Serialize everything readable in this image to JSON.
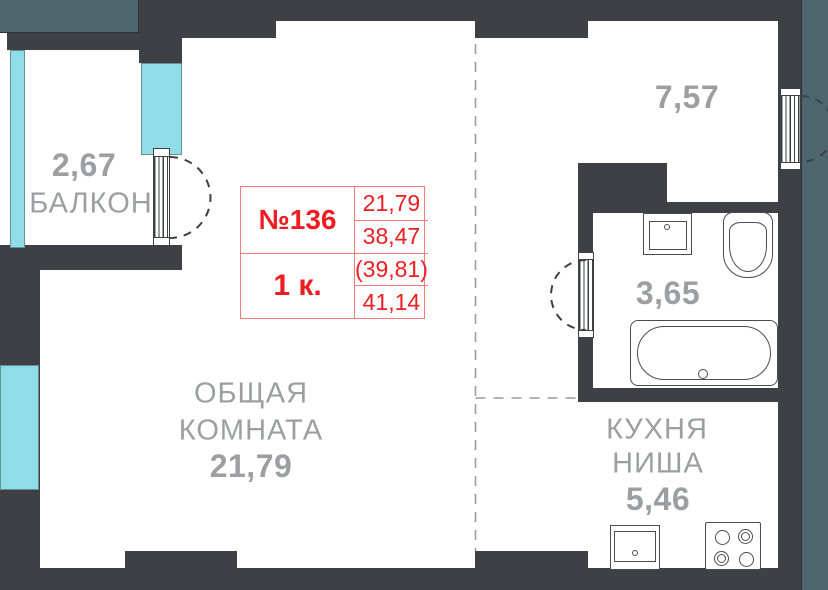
{
  "palette": {
    "wall": "#3f4046",
    "outside": "#4d666e",
    "glass": "#90dde8",
    "label": "#9c9ea1",
    "red_text": "#ee1d23",
    "red_border": "#f57c7c",
    "fixture": "#4b4c52",
    "zone": "#9a9a9a"
  },
  "info_card": {
    "number": "№136",
    "type": "1 к.",
    "areas": [
      "21,79",
      "38,47",
      "(39,81)",
      "41,14"
    ]
  },
  "rooms": {
    "balcony": {
      "area": "2,67",
      "name": "БАЛКОН"
    },
    "living": {
      "name_line1": "ОБЩАЯ",
      "name_line2": "КОМНАТА",
      "area": "21,79"
    },
    "hall": {
      "area": "7,57"
    },
    "bathroom": {
      "area": "3,65"
    },
    "kitchen": {
      "name_line1": "КУХНЯ",
      "name_line2": "НИША",
      "area": "5,46"
    }
  }
}
